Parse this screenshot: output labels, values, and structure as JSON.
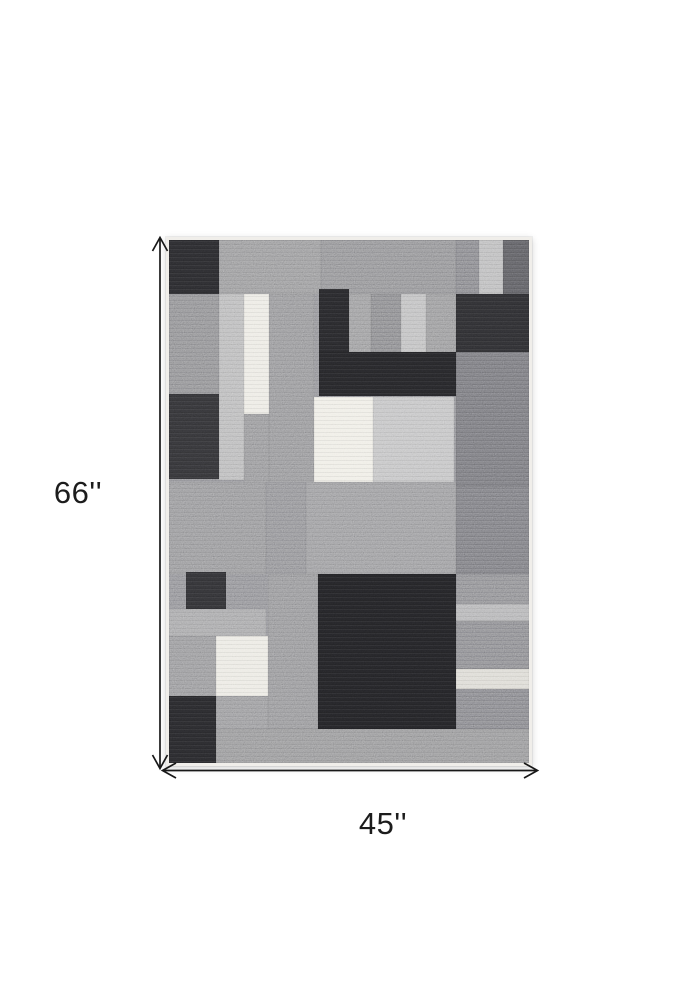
{
  "figure": {
    "subject": "grey geometric patchwork area rug, top view",
    "background_color": "#ffffff"
  },
  "dimensions": {
    "height_label": "66''",
    "width_label": "45''",
    "arrow_color": "#181818",
    "label_color": "#1c1c1c"
  },
  "rug": {
    "left": 166,
    "top": 237,
    "width": 366,
    "height": 529,
    "edge_color": "#f0eeea",
    "base_color": "#85858a",
    "palette": {
      "near_black": "#232326",
      "dark_gray": "#303033",
      "medium_gray": "#8a8a8d",
      "light_gray": "#b4b4b5",
      "cream": "#eae8e1"
    },
    "blocks": [
      [
        0,
        0,
        50,
        54,
        "#28282b"
      ],
      [
        50,
        0,
        102,
        54,
        "#8e8e90"
      ],
      [
        152,
        0,
        135,
        54,
        "#868689"
      ],
      [
        287,
        0,
        23,
        54,
        "#7c7c80"
      ],
      [
        310,
        0,
        24,
        54,
        "#b4b4b5"
      ],
      [
        334,
        0,
        26,
        54,
        "#58585c"
      ],
      [
        0,
        54,
        50,
        100,
        "#838386"
      ],
      [
        0,
        154,
        50,
        85,
        "#303033"
      ],
      [
        50,
        54,
        25,
        186,
        "#b2b2b3"
      ],
      [
        75,
        54,
        25,
        120,
        "#eae8e1"
      ],
      [
        75,
        174,
        25,
        72,
        "#8b8b8e"
      ],
      [
        100,
        54,
        45,
        192,
        "#8a8a8d"
      ],
      [
        150,
        49,
        30,
        63,
        "#252528"
      ],
      [
        180,
        54,
        22,
        58,
        "#919193"
      ],
      [
        202,
        54,
        30,
        58,
        "#7e7e81"
      ],
      [
        232,
        54,
        25,
        58,
        "#b8b8b9"
      ],
      [
        257,
        54,
        30,
        58,
        "#8e8e90"
      ],
      [
        287,
        54,
        73,
        58,
        "#2b2b2e"
      ],
      [
        150,
        112,
        137,
        44,
        "#232326"
      ],
      [
        287,
        112,
        73,
        134,
        "#6f6f73"
      ],
      [
        145,
        157,
        59,
        85,
        "#edebe3"
      ],
      [
        204,
        157,
        81,
        85,
        "#bcbcbd"
      ],
      [
        0,
        242,
        97,
        92,
        "#8b8b8e"
      ],
      [
        97,
        242,
        40,
        92,
        "#86868a"
      ],
      [
        137,
        242,
        150,
        92,
        "#909093"
      ],
      [
        287,
        246,
        73,
        88,
        "#737377"
      ],
      [
        17,
        332,
        40,
        37,
        "#2e2e31"
      ],
      [
        0,
        369,
        97,
        27,
        "#9d9d9f"
      ],
      [
        0,
        396,
        47,
        60,
        "#8c8c8f"
      ],
      [
        47,
        396,
        52,
        60,
        "#e9e7e0"
      ],
      [
        0,
        456,
        47,
        67,
        "#262629"
      ],
      [
        47,
        456,
        52,
        33,
        "#8e8e91"
      ],
      [
        99,
        334,
        50,
        155,
        "#8a8a8d"
      ],
      [
        149,
        334,
        138,
        155,
        "#212124"
      ],
      [
        287,
        334,
        73,
        30,
        "#828286"
      ],
      [
        287,
        364,
        73,
        17,
        "#ababad"
      ],
      [
        287,
        381,
        73,
        48,
        "#7f7f83"
      ],
      [
        287,
        429,
        73,
        20,
        "#d8d6cf"
      ],
      [
        287,
        449,
        73,
        40,
        "#7b7b7f"
      ],
      [
        47,
        489,
        313,
        34,
        "#8b8b8d"
      ]
    ]
  }
}
